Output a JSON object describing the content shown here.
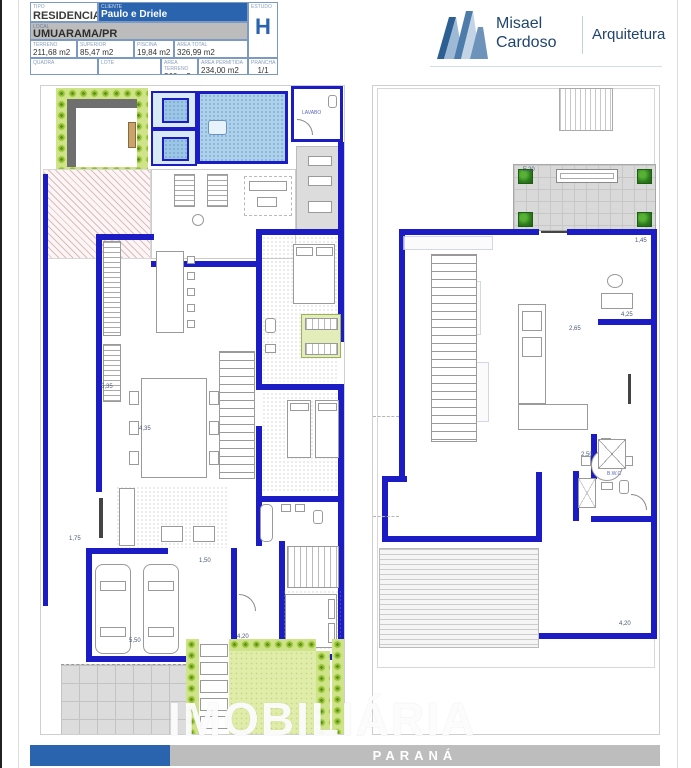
{
  "document": {
    "watermark": "IMOBILIÁRIA",
    "footer_region": "PARANÁ"
  },
  "title_block": {
    "tipo_label": "TIPO",
    "tipo_value": "RESIDENCIAL",
    "cliente_label": "CLIENTE",
    "cliente_value": "Paulo e Driele",
    "local_label": "LOCAL",
    "local_value": "UMUARAMA/PR",
    "estudo_label": "ESTUDO",
    "estudo_value": "H",
    "terreno_label": "TERRENO",
    "terreno_value": "211,68 m2",
    "superior_label": "SUPERIOR",
    "superior_value": "85,47 m2",
    "piscina_label": "PISCINA",
    "piscina_value": "19,84 m2",
    "area_total_label": "AREA TOTAL",
    "area_total_value": "326,99 m2",
    "quadra_label": "QUADRA",
    "lote_label": "LOTE",
    "area_terreno_label": "AREA TERRENO",
    "area_terreno_value": "360 m2",
    "area_permitida_label": "AREA PERMITIDA",
    "area_permitida_value": "234,00 m2",
    "prancha_label": "PRANCHA",
    "prancha_value": "1/1"
  },
  "logo": {
    "first_name": "Misael",
    "last_name": "Cardoso",
    "tagline": "Arquitetura"
  },
  "plans": {
    "left": {
      "labels": {
        "lavabo": "LAVABO"
      },
      "dims": {
        "d1": "4,35",
        "d2": "5,35",
        "d3": "1,75",
        "d4": "5,50",
        "d5": "4,20",
        "d6": "1,50"
      }
    },
    "right": {
      "labels": {
        "bwc": "B.W.C"
      },
      "dims": {
        "d1": "5,20",
        "d2": "2,65",
        "d3": "4,25",
        "d4": "2,50",
        "d5": "4,20",
        "d6": "1,45"
      }
    }
  },
  "colors": {
    "wall_blue": "#1c1cc4",
    "header_blue": "#2a64ae",
    "header_gray": "#bdbdbd",
    "pool_blue": "#aed2ec",
    "hedge_green": "#8fbf35",
    "lawn_green": "#e0ecaa",
    "logo_navy": "#20456e"
  }
}
